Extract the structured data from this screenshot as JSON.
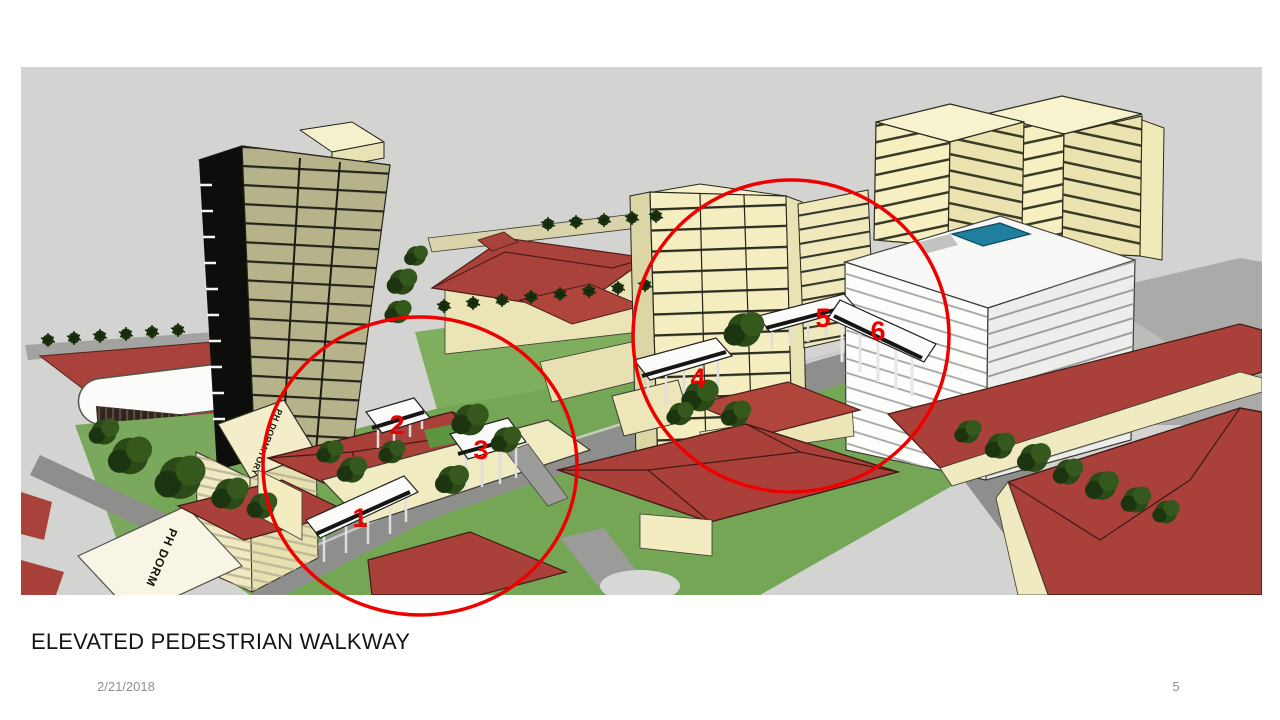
{
  "slide": {
    "title": "ELEVATED PEDESTRIAN WALKWAY",
    "date": "2/21/2018",
    "page_number": "5"
  },
  "scene": {
    "labels": {
      "dorm_roof": "PH DORM",
      "dormitory_tower_roof": "PH DORMITORY"
    },
    "walkway_numbers": [
      "1",
      "2",
      "3",
      "4",
      "5",
      "6"
    ],
    "colors": {
      "annotation_red": "#ee0000",
      "sky_gray": "#d3d3d1",
      "building_cream": "#f3edbe",
      "tower_khaki": "#b6b28a",
      "roof_red": "#a9413a",
      "grass_green": "#74a656",
      "road_gray": "#8e8e8c",
      "white_building": "#fbfbfa",
      "pool_teal": "#1f7f9d"
    }
  }
}
